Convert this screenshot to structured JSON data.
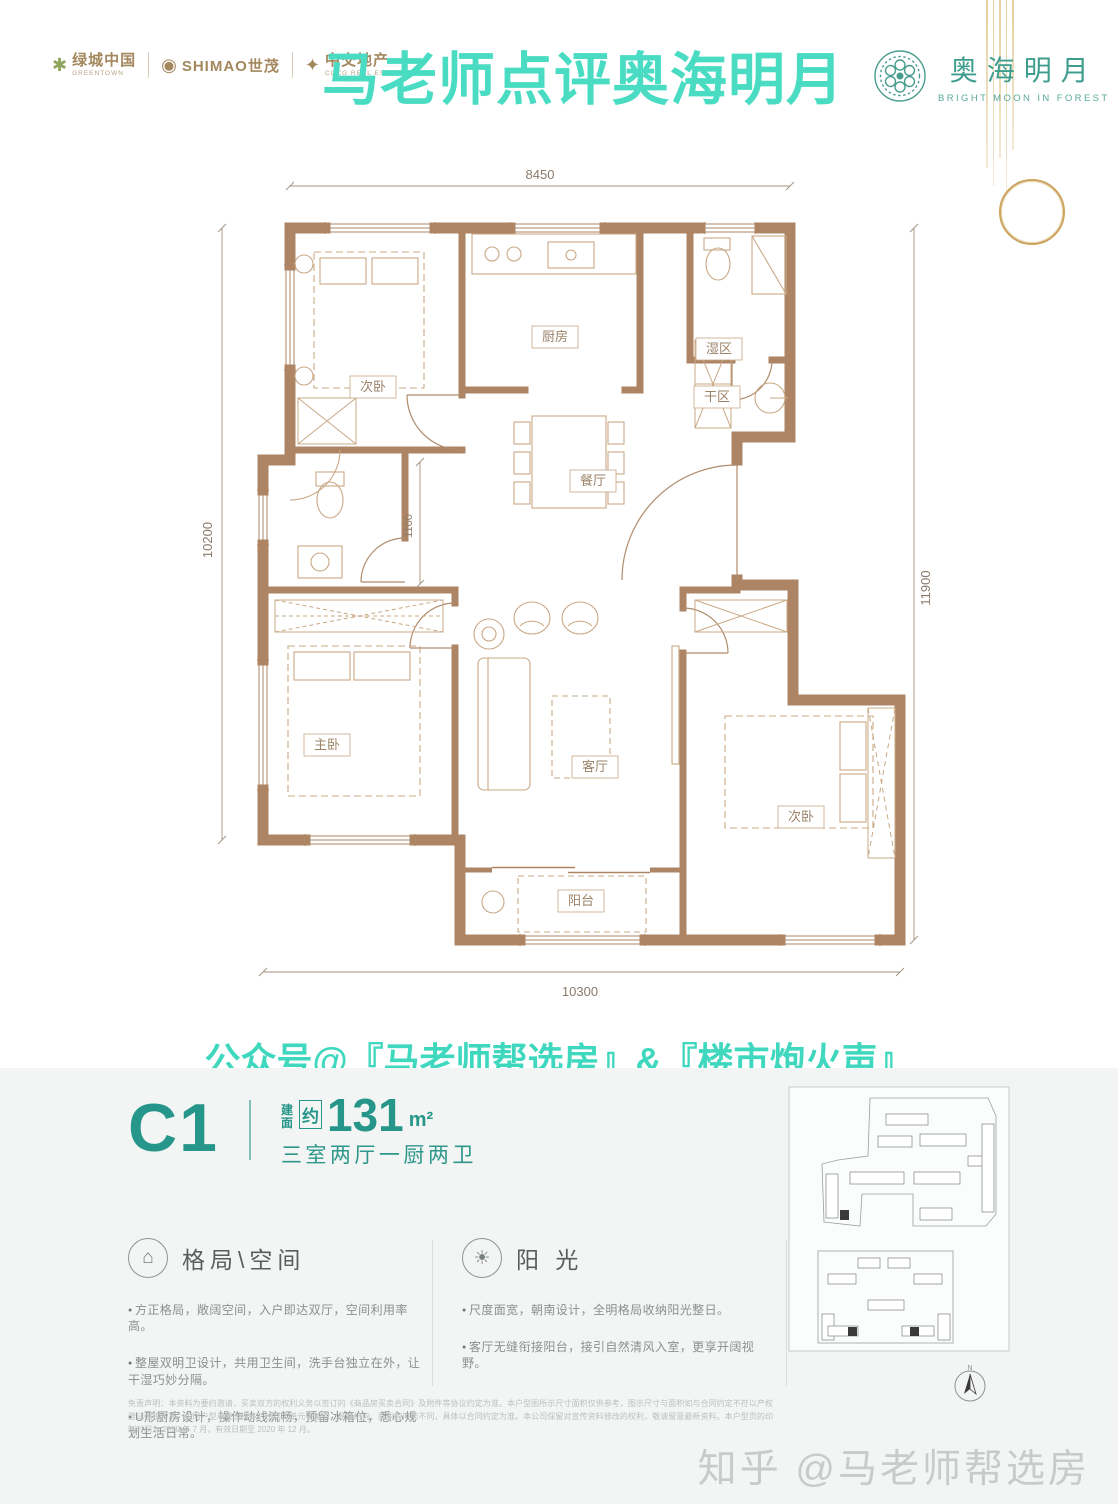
{
  "header": {
    "logos": {
      "greentown": {
        "name": "绿城中国",
        "sub": "GREENTOWN"
      },
      "shimao": {
        "name": "SHIMAO世茂"
      },
      "cccg": {
        "name": "中交地产",
        "sub": "CCCG REAL ESTATE"
      }
    },
    "title": "马老师点评奥海明月",
    "brand": {
      "name": "奥海明月",
      "subtitle": "BRIGHT MOON IN FOREST"
    }
  },
  "floorplan": {
    "dimensions": {
      "top": "8450",
      "left": "10200",
      "right": "11900",
      "bottom": "10300",
      "bath": "1100"
    },
    "rooms": {
      "bedroom_top": "次卧",
      "kitchen": "厨房",
      "wet_zone": "湿区",
      "dry_zone": "干区",
      "dining": "餐厅",
      "living": "客厅",
      "master": "主卧",
      "bedroom_right": "次卧",
      "balcony": "阳台"
    }
  },
  "social_line": "公众号@『马老师帮选房』&『楼市炮火声』",
  "unit": {
    "code": "C1",
    "area_label": "建面",
    "approx": "约",
    "area_value": "131",
    "area_unit": "m²",
    "layout_desc": "三室两厅一厨两卫"
  },
  "features": [
    {
      "title": "格局\\空间",
      "bullets": [
        "方正格局，敞阔空间，入户即达双厅，空间利用率高。",
        "整屋双明卫设计，共用卫生间，洗手台独立在外，让干湿巧妙分隔。",
        "U形厨房设计，操作动线流畅，预留冰箱位，悉心规划生活日常。"
      ]
    },
    {
      "title": "阳 光",
      "bullets": [
        "尺度面宽，朝南设计，全明格局收纳阳光整日。",
        "客厅无缝衔接阳台，接引自然清风入室，更享开阔视野。"
      ]
    }
  ],
  "siteplan": {
    "compass": "N"
  },
  "disclaimer": "免责声明：本资料为要约邀请，买卖双方的权利义务以签订的《商品房买卖合同》及附件等协议约定为准。本户型图所示尺寸面积仅供参考，图示尺寸与面积如与合同约定不符以产权登记面积为准；相同户型单位因楼栋、楼层、单元等差别，局部结构、面积等可能不同，具体以合同约定为准。本公司保留对宣传资料修改的权利，敬请留意最新资料。本户型页的印制时间为 2020 年 7 月，有效日期至 2020 年 12 月。",
  "watermark": "知乎 @马老师帮选房",
  "colors": {
    "title_teal": "#49dcc3",
    "brand_teal": "#3f9d8d",
    "unit_teal": "#27968a",
    "wall_brown": "#ae8564",
    "furniture_brown": "#c9a886",
    "gold": "#cba35c"
  }
}
